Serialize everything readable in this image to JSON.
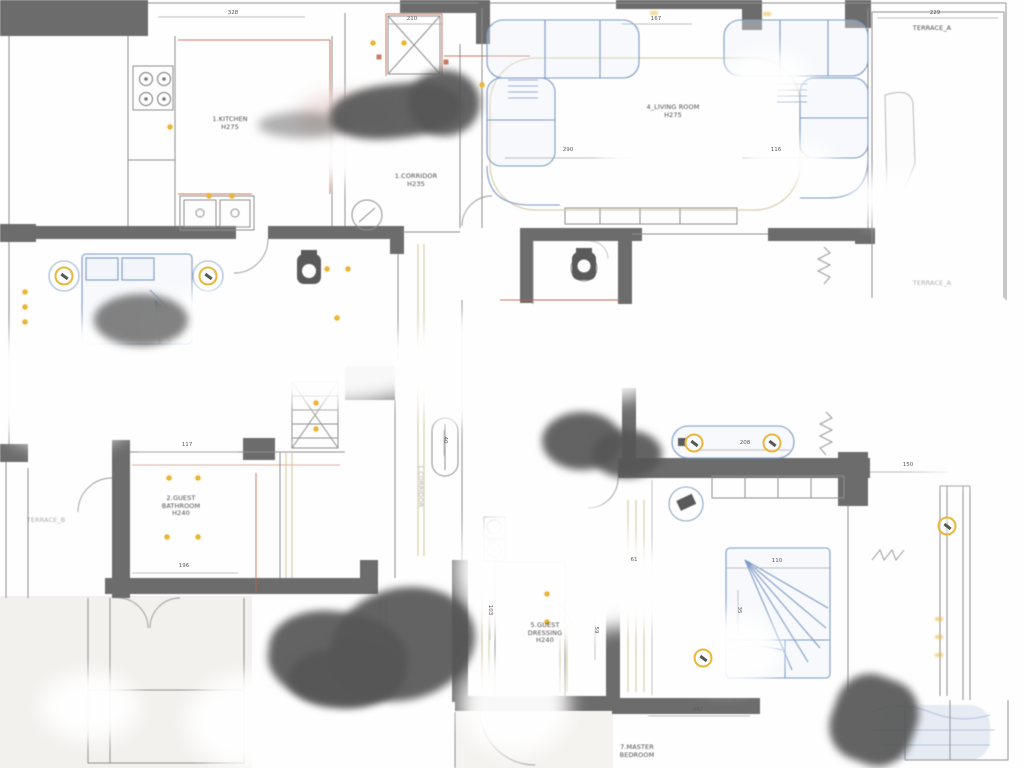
{
  "document": {
    "type": "architectural floor plan",
    "description": "blurred scan of an apartment ceiling / lighting plan with gray walls, blue furniture outlines and yellow light fixtures"
  },
  "colors": {
    "wall": "#6c6c6c",
    "line": "#8f8f8f",
    "furniture_blue": "#7d9bc8",
    "accent_red": "#c0654a",
    "beige": "#d8c9a4",
    "light_yellow": "#e9b83a",
    "text": "#4a4a4a"
  },
  "plan": {
    "room_labels": [
      {
        "id": "kitchen",
        "x": 230,
        "y": 116,
        "lines": [
          "1.KITCHEN",
          "H275"
        ]
      },
      {
        "id": "corridor",
        "x": 416,
        "y": 173,
        "lines": [
          "1.CORRIDOR",
          "H235"
        ]
      },
      {
        "id": "living-room",
        "x": 673,
        "y": 104,
        "lines": [
          "4_LIVING ROOM",
          "H275"
        ]
      },
      {
        "id": "terrace-a-top",
        "x": 932,
        "y": 25,
        "lines": [
          "TERRACE_A"
        ]
      },
      {
        "id": "terrace-a-mid",
        "x": 932,
        "y": 280,
        "lines": [
          "TERRACE_A"
        ],
        "faint": true
      },
      {
        "id": "terrace-b",
        "x": 46,
        "y": 517,
        "lines": [
          "TERRACE_B"
        ],
        "faint": true
      },
      {
        "id": "guest-bathroom",
        "x": 181,
        "y": 495,
        "lines": [
          "2.GUEST",
          "BATHROOM",
          "H240"
        ]
      },
      {
        "id": "guest-dressing",
        "x": 545,
        "y": 622,
        "lines": [
          "5.GUEST",
          "DRESSING",
          "H240"
        ]
      },
      {
        "id": "master-bedroom",
        "x": 637,
        "y": 744,
        "lines": [
          "7.MASTER",
          "BEDROOM"
        ]
      },
      {
        "id": "corridor-vertical",
        "x": 420,
        "y": 486,
        "lines": [
          "1.CORRIDOR"
        ],
        "rot": 90,
        "faint": true
      }
    ],
    "dimension_labels": [
      {
        "x": 233,
        "y": 13,
        "t": "328"
      },
      {
        "x": 412,
        "y": 19,
        "t": "210"
      },
      {
        "x": 656,
        "y": 19,
        "t": "167"
      },
      {
        "x": 935,
        "y": 13,
        "t": "229"
      },
      {
        "x": 568,
        "y": 150,
        "t": "290"
      },
      {
        "x": 776,
        "y": 150,
        "t": "116"
      },
      {
        "x": 745,
        "y": 443,
        "t": "208"
      },
      {
        "x": 777,
        "y": 561,
        "t": "110"
      },
      {
        "x": 634,
        "y": 560,
        "t": "61"
      },
      {
        "x": 187,
        "y": 445,
        "t": "117"
      },
      {
        "x": 184,
        "y": 566,
        "t": "196"
      },
      {
        "x": 908,
        "y": 465,
        "t": "150"
      },
      {
        "x": 698,
        "y": 710,
        "t": "462"
      },
      {
        "x": 490,
        "y": 610,
        "t": "103",
        "rot": 90
      },
      {
        "x": 596,
        "y": 630,
        "t": "59",
        "rot": 90
      },
      {
        "x": 739,
        "y": 610,
        "t": "35",
        "rot": 90
      },
      {
        "x": 445,
        "y": 440,
        "t": "40",
        "rot": 90
      }
    ],
    "lights": {
      "ceiling_dots": [
        [
          170,
          127
        ],
        [
          209,
          196
        ],
        [
          232,
          196
        ],
        [
          373,
          43
        ],
        [
          404,
          43
        ],
        [
          482,
          85
        ],
        [
          327,
          269
        ],
        [
          348,
          269
        ],
        [
          337,
          318
        ],
        [
          316,
          403
        ],
        [
          316,
          429
        ],
        [
          25,
          292
        ],
        [
          25,
          307
        ],
        [
          25,
          322
        ],
        [
          169,
          478
        ],
        [
          198,
          478
        ],
        [
          167,
          537
        ],
        [
          198,
          537
        ],
        [
          547,
          594
        ],
        [
          547,
          622
        ]
      ],
      "ring_fixtures": [
        [
          64,
          276
        ],
        [
          208,
          276
        ],
        [
          694,
          443
        ],
        [
          772,
          443
        ],
        [
          703,
          658
        ],
        [
          947,
          526
        ]
      ],
      "small_marks": [
        [
          939,
          619
        ],
        [
          939,
          637
        ],
        [
          939,
          655
        ],
        [
          654,
          13
        ],
        [
          767,
          14
        ]
      ]
    }
  }
}
